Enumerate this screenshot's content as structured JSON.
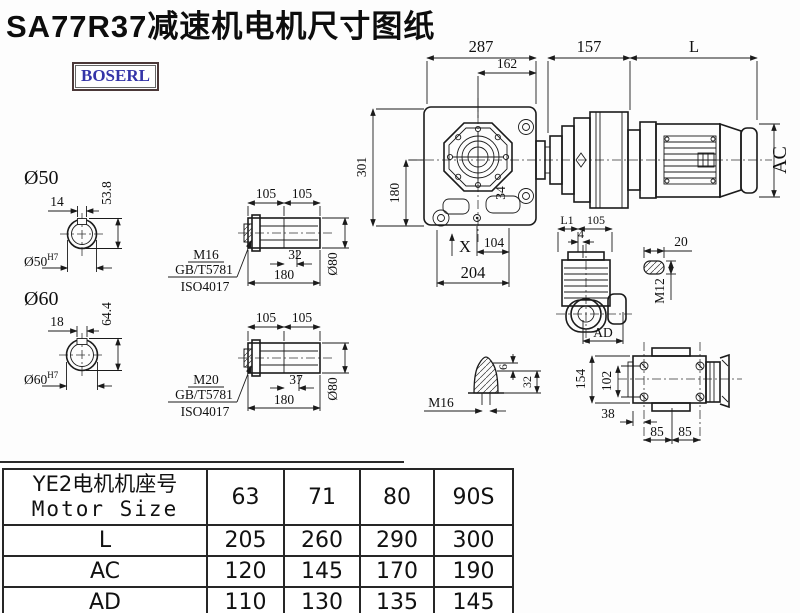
{
  "title": "SA77R37减速机电机尺寸图纸",
  "logo": "BOSERL",
  "main_view": {
    "dim_287": "287",
    "dim_162": "162",
    "dim_157": "157",
    "dim_l": "L",
    "dim_301": "301",
    "dim_180": "180",
    "dim_34": "34",
    "label_x": "X",
    "dim_104": "104",
    "dim_204": "204",
    "dim_ac": "AC"
  },
  "shaft_50": {
    "label": "Ø50",
    "dim_key_width": "14",
    "dim_height": "53.8",
    "bore": "Ø50",
    "bore_tol": "H7"
  },
  "shaft_60": {
    "label": "Ø60",
    "dim_key_width": "18",
    "dim_height": "64.4",
    "bore": "Ø60",
    "bore_tol": "H7"
  },
  "sleeve_m16": {
    "dim_105a": "105",
    "dim_105b": "105",
    "thread": "M16",
    "std_gb": "GB/T5781",
    "std_iso": "ISO4017",
    "dim_32": "32",
    "dim_180": "180",
    "dim_dia": "Ø80"
  },
  "sleeve_m20": {
    "dim_105a": "105",
    "dim_105b": "105",
    "thread": "M20",
    "std_gb": "GB/T5781",
    "std_iso": "ISO4017",
    "dim_37": "37",
    "dim_180": "180",
    "dim_dia": "Ø80"
  },
  "side_view": {
    "dim_l1": "L1",
    "dim_105": "105",
    "dim_4": "4",
    "dim_ad": "AD"
  },
  "key_detail": {
    "dim_20": "20",
    "thread": "M12"
  },
  "plug_detail": {
    "thread": "M16",
    "dim_6": "6",
    "dim_32": "32"
  },
  "top_view": {
    "dim_154": "154",
    "dim_102": "102",
    "dim_38": "38",
    "dim_85a": "85",
    "dim_85b": "85"
  },
  "table": {
    "header_cn": "YE2电机机座号",
    "header_en": "Motor Size",
    "sizes": [
      "63",
      "71",
      "80",
      "90S"
    ],
    "rows": [
      {
        "label": "L",
        "values": [
          "205",
          "260",
          "290",
          "300"
        ]
      },
      {
        "label": "AC",
        "values": [
          "120",
          "145",
          "170",
          "190"
        ]
      },
      {
        "label": "AD",
        "values": [
          "110",
          "130",
          "135",
          "145"
        ]
      }
    ]
  }
}
